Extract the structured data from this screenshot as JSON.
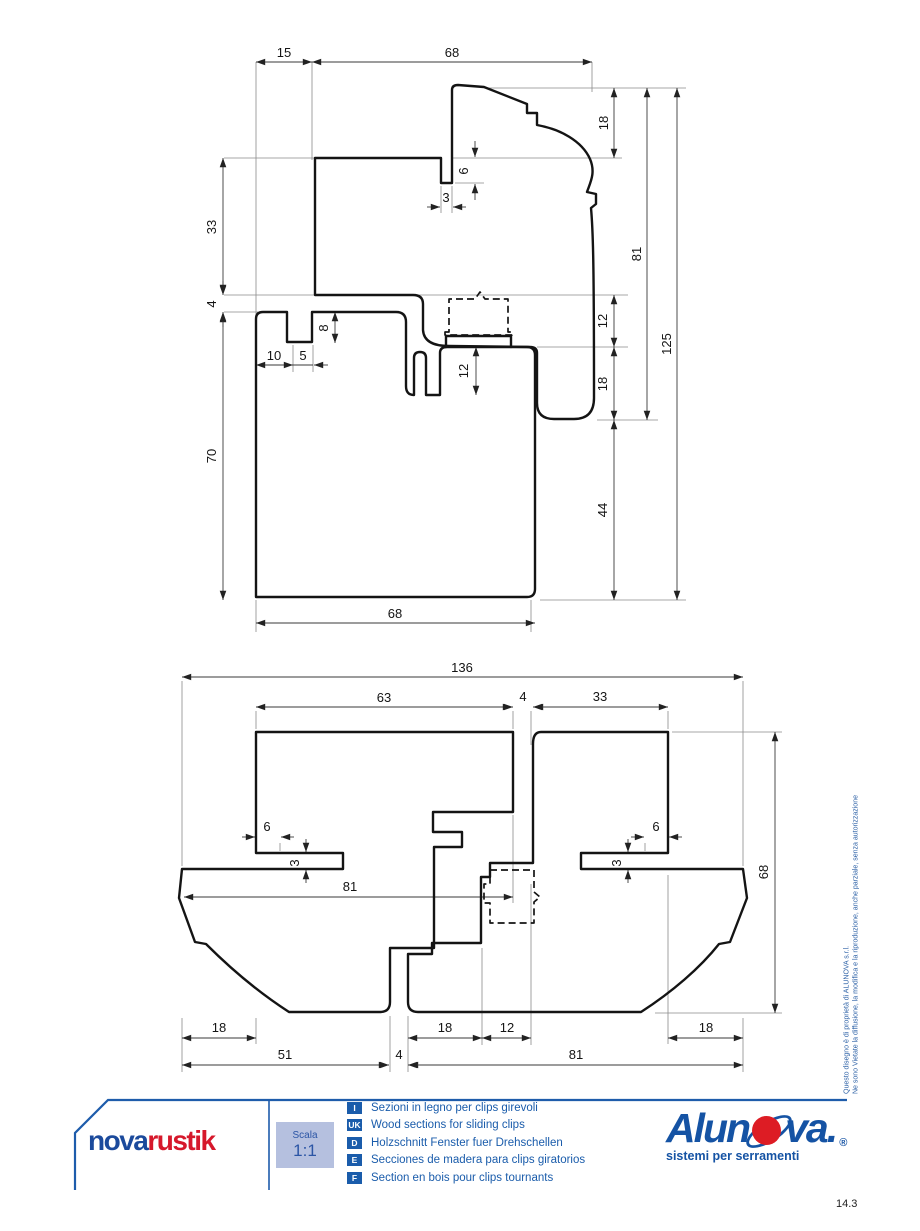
{
  "top_drawing": {
    "title": "vertical section",
    "dims": {
      "d15": "15",
      "d68t": "68",
      "d18t": "18",
      "d6": "6",
      "d3": "3",
      "d33": "33",
      "d4": "4",
      "d8": "8",
      "d10": "10",
      "d5": "5",
      "d12m": "12",
      "d12r": "12",
      "d18r": "18",
      "d81": "81",
      "d125": "125",
      "d44": "44",
      "d70": "70",
      "d68b": "68"
    }
  },
  "bottom_drawing": {
    "title": "horizontal section",
    "dims": {
      "d136": "136",
      "d63": "63",
      "d4t": "4",
      "d33": "33",
      "d6l": "6",
      "d3l": "3",
      "d81m": "81",
      "d6r": "6",
      "d3r": "3",
      "d68": "68",
      "d18l": "18",
      "d51": "51",
      "d4b": "4",
      "d18m": "18",
      "d12": "12",
      "d81b": "81",
      "d18r": "18"
    }
  },
  "footer": {
    "brand_left": {
      "part1": "nova",
      "part2": "rustik"
    },
    "scale_label": "Scala",
    "scale_value": "1:1",
    "legend": [
      {
        "tag": "I",
        "text": "Sezioni in legno per clips girevoli"
      },
      {
        "tag": "UK",
        "text": "Wood sections for sliding clips"
      },
      {
        "tag": "D",
        "text": "Holzschnitt Fenster fuer Drehschellen"
      },
      {
        "tag": "E",
        "text": "Secciones de madera para clips giratorios"
      },
      {
        "tag": "F",
        "text": "Section en bois pour clips tournants"
      }
    ],
    "brand_right": {
      "name_start": "Alun",
      "name_end": "va",
      "dot": ".",
      "registered": "®",
      "tagline": "sistemi per serramenti"
    },
    "page_number": "14.3"
  },
  "side_note": {
    "line1": "Questo disegno è di proprietà di ALUNOVA s.r.l.",
    "line2": "Ne sono Vietate la diffusione, la modifica e la riproduzione, anche parziale, senza autorizzazione"
  },
  "colors": {
    "brand_blue": "#1b4a9c",
    "brand_red": "#d6182b",
    "legend_blue": "#1a5cab",
    "scala_bg": "#b5c0df",
    "line_black": "#141414"
  }
}
